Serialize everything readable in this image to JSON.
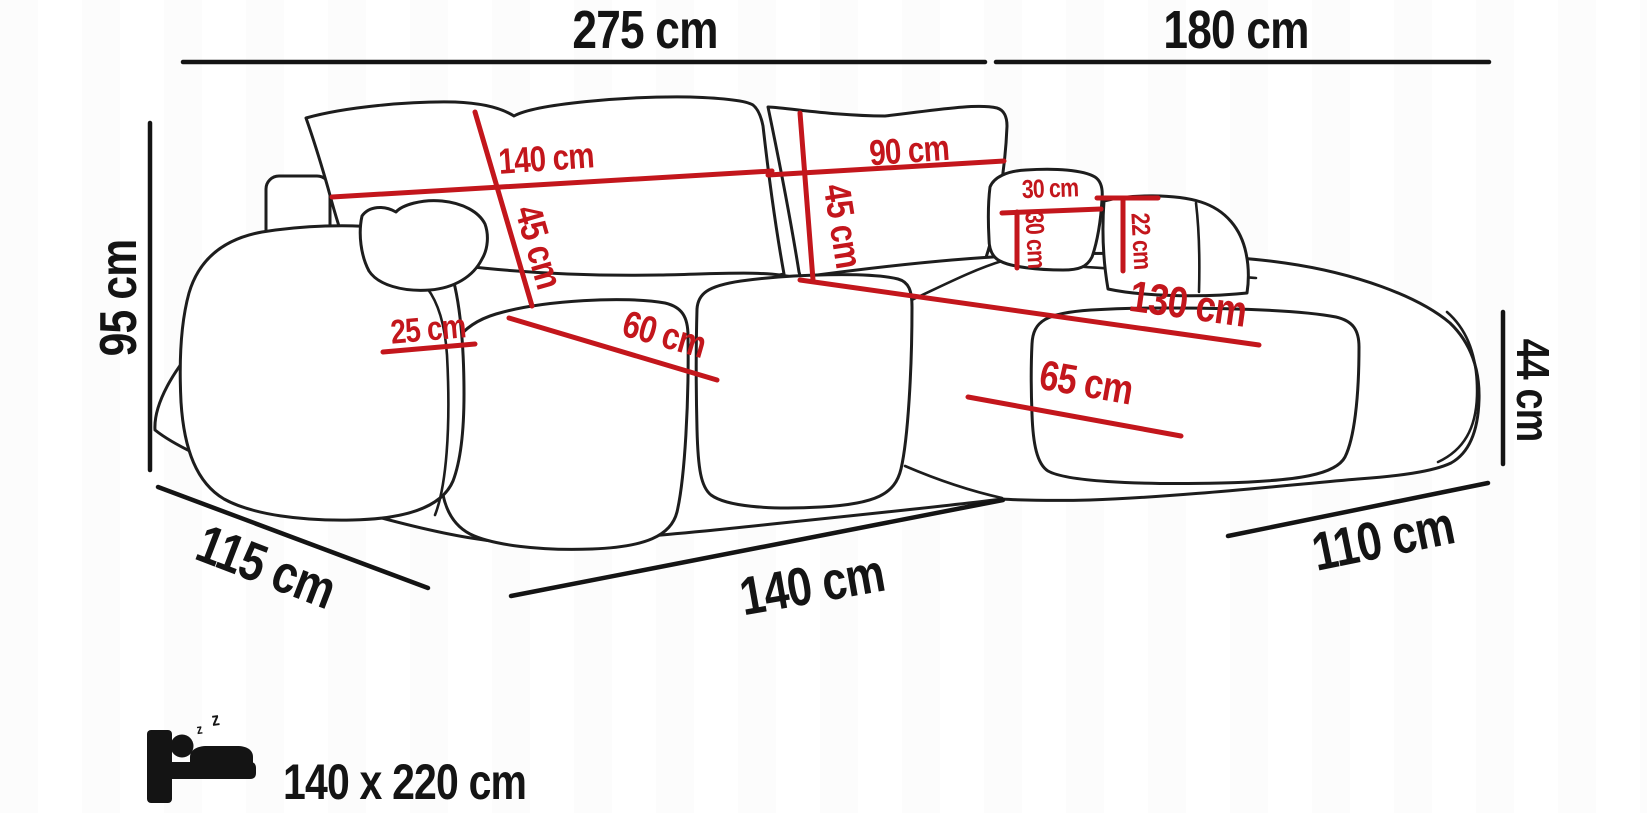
{
  "colors": {
    "background": "#ffffff",
    "ink": "#141414",
    "line_art": "#1d1d1d",
    "accent_red": "#c3161c"
  },
  "dimensions_black": {
    "overall_width": "275 cm",
    "chaise_overall_depth": "180 cm",
    "overall_height": "95 cm",
    "seat_height": "44 cm",
    "side_depth": "115 cm",
    "front_width": "140 cm",
    "chaise_front_width": "110 cm"
  },
  "dimensions_red": {
    "back_cushion_left_width": "140 cm",
    "back_cushion_left_height": "45 cm",
    "back_cushion_right_width": "90 cm",
    "back_cushion_right_height": "45 cm",
    "pillow_width": "30 cm",
    "pillow_height": "30 cm",
    "armrest_right_height": "22 cm",
    "armrest_left_width": "25 cm",
    "seat_cushion_depth": "60 cm",
    "chaise_seat_length": "130 cm",
    "chaise_seat_width": "65 cm"
  },
  "sleeping_function": {
    "bed_size": "140 x 220 cm",
    "zz": [
      "z",
      "z"
    ]
  }
}
